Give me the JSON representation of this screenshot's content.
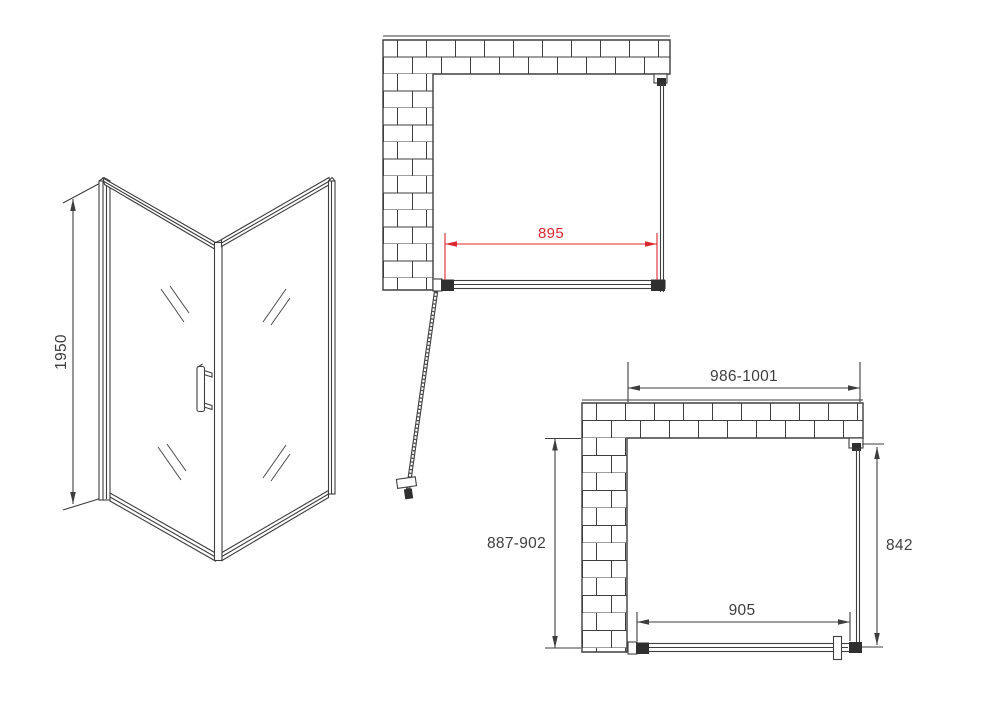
{
  "drawing": {
    "type": "shower-enclosure-technical-drawing",
    "colors": {
      "line": "#3e3e3e",
      "accent_red": "#d8282e",
      "background": "#ffffff"
    },
    "isometric_view": {
      "height_label": "1950"
    },
    "plan_view_top": {
      "door_width_label": "895"
    },
    "plan_view_bottom": {
      "overall_width_label": "986-1001",
      "wall_opening_label": "887-902",
      "side_panel_depth_label": "842",
      "door_width_label": "905"
    }
  }
}
